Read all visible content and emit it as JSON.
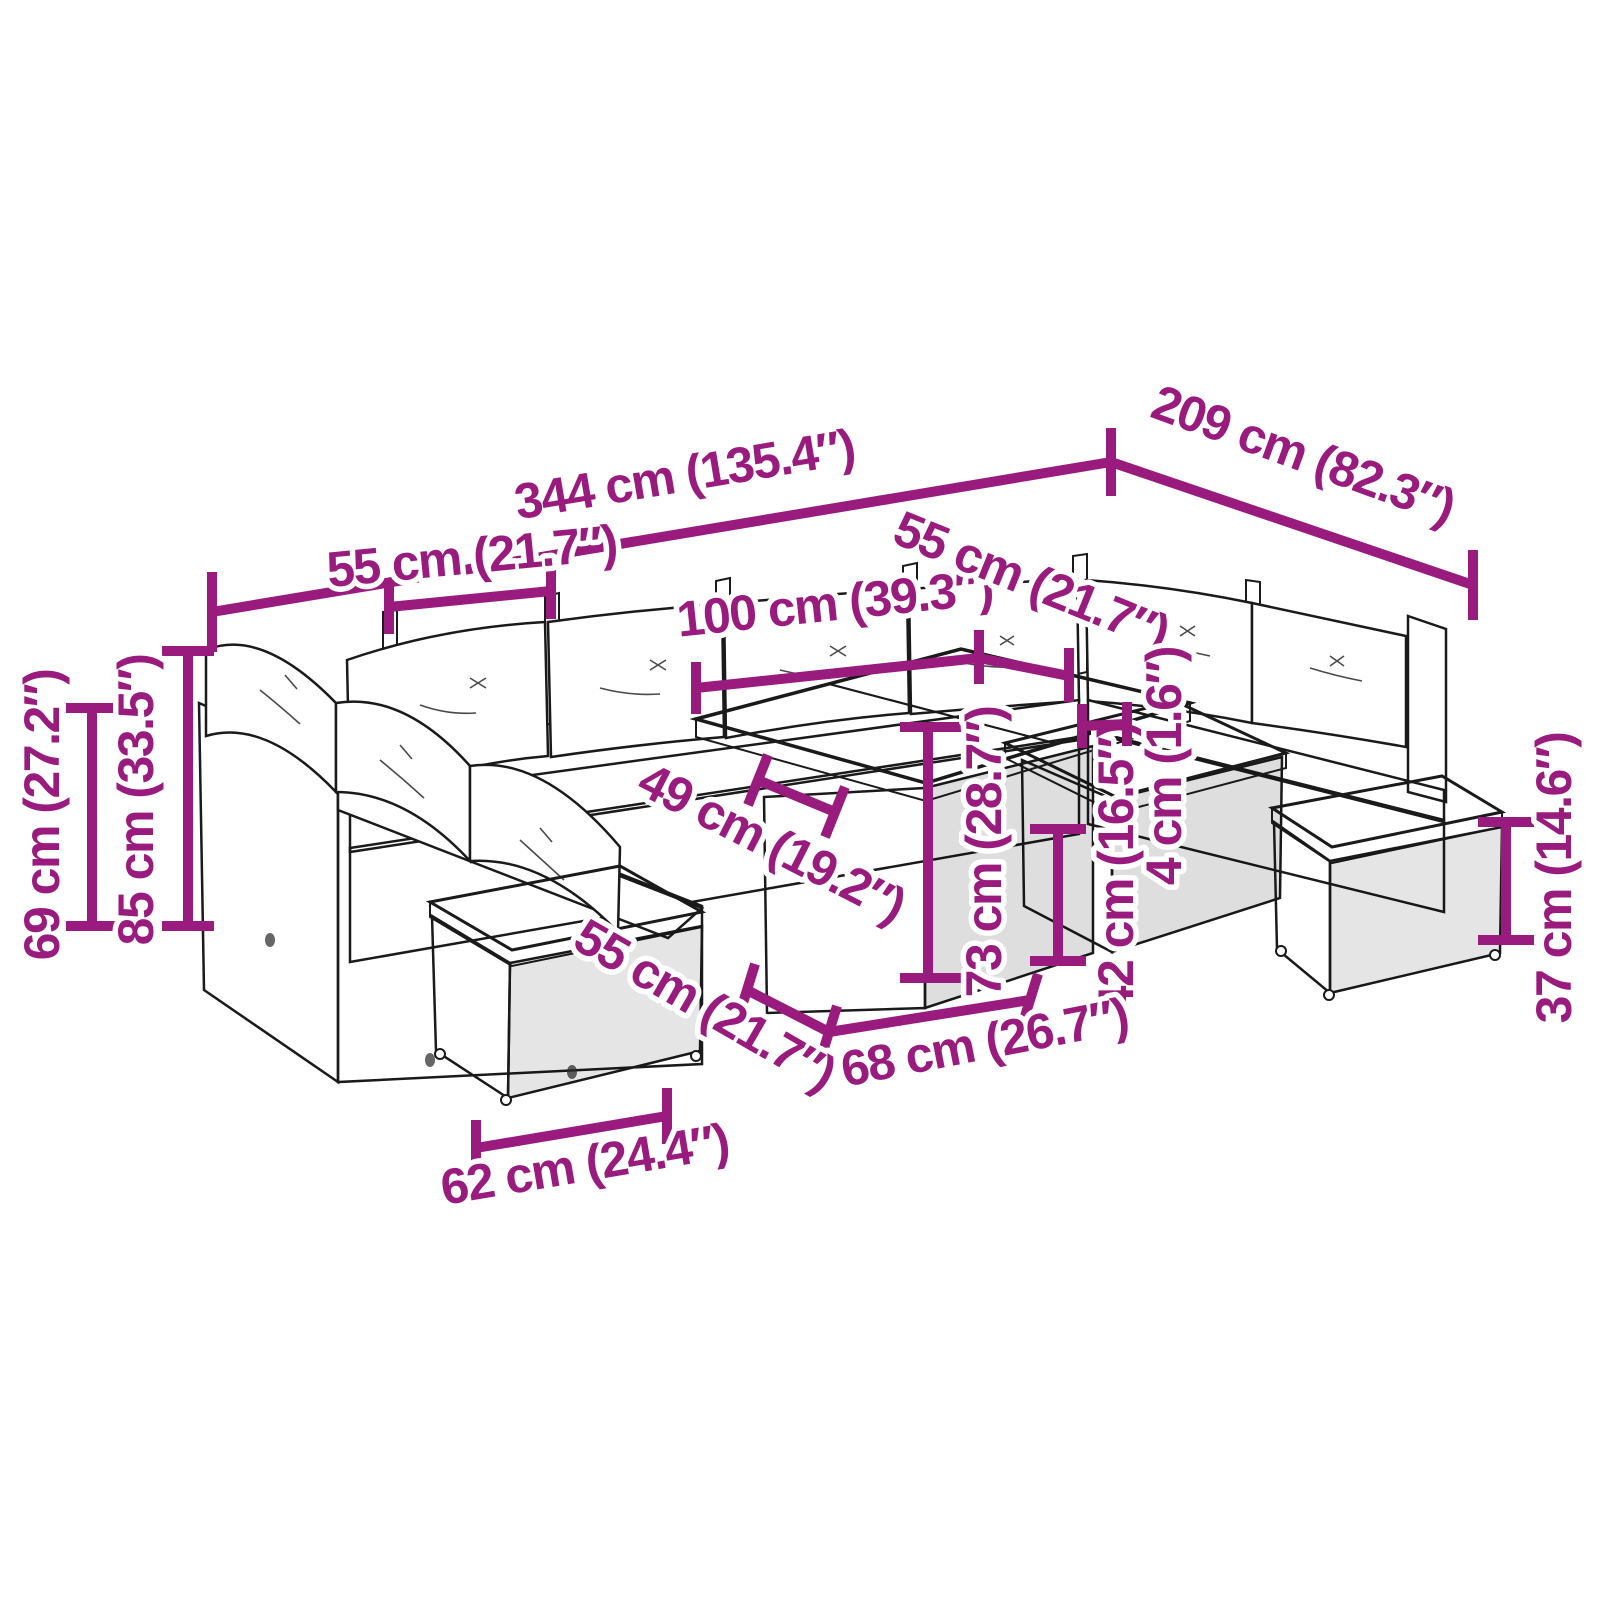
{
  "canvas": {
    "width": 1600,
    "height": 1600,
    "background": "#ffffff"
  },
  "accent_color": "#9A1B7E",
  "line_art_color": "#1a1a1a",
  "subject": "11-piece garden lounge set with table and footstools - dimension diagram",
  "dims": {
    "total_width": {
      "cm": 344,
      "inches": 135.4,
      "label": "344 cm (135.4″)"
    },
    "total_depth": {
      "cm": 209,
      "inches": 82.3,
      "label": "209 cm (82.3″)"
    },
    "back_seat_width": {
      "cm": 55,
      "inches": 21.7,
      "label": "55 cm (21.7″)"
    },
    "table_top_length": {
      "cm": 100,
      "inches": 39.3,
      "label": "100 cm (39.3″)"
    },
    "right_seat_width": {
      "cm": 55,
      "inches": 21.7,
      "label": "55 cm (21.7″)"
    },
    "seat_depth": {
      "cm": 49,
      "inches": 19.2,
      "label": "49 cm (19.2″)"
    },
    "table_height": {
      "cm": 73,
      "inches": 28.7,
      "label": "73 cm (28.7″)"
    },
    "side_table_height": {
      "cm": 42,
      "inches": 16.5,
      "label": "42 cm (16.5″)"
    },
    "top_thickness": {
      "cm": 4,
      "inches": 1.6,
      "label": "4 cm (1.6″)"
    },
    "table_top_depth": {
      "cm": 68,
      "inches": 26.7,
      "label": "68 cm (26.7″)"
    },
    "stool_seat_depth": {
      "cm": 55,
      "inches": 21.7,
      "label": "55 cm (21.7″)"
    },
    "stool_width": {
      "cm": 62,
      "inches": 24.4,
      "label": "62 cm (24.4″)"
    },
    "back_height": {
      "cm": 69,
      "inches": 27.2,
      "label": "69 cm (27.2″)"
    },
    "total_height": {
      "cm": 85,
      "inches": 33.5,
      "label": "85 cm (33.5″)"
    },
    "stool_height": {
      "cm": 37,
      "inches": 14.6,
      "label": "37 cm (14.6″)"
    }
  }
}
